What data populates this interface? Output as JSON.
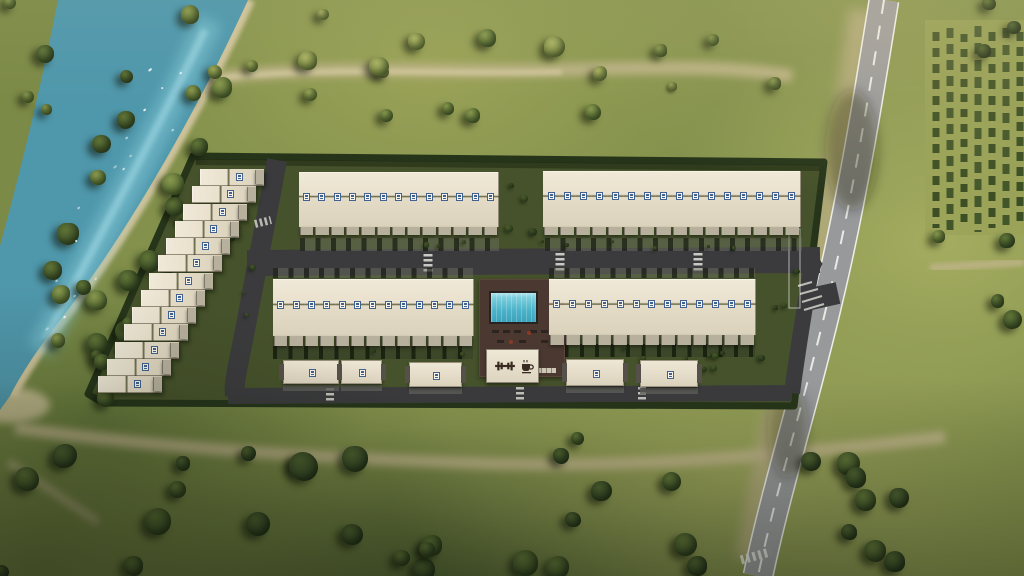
{
  "scene": {
    "title": "Aerial 3D render of a gated townhouse residential development beside a river and a country road"
  },
  "compound": {
    "blocks": [
      {
        "id": "left-stepped-row",
        "label": "stepped townhouse row",
        "units": 13
      },
      {
        "id": "top-left-row",
        "label": "north-west townhouse row",
        "units": 13
      },
      {
        "id": "top-right-row",
        "label": "north-east townhouse row",
        "units": 16
      },
      {
        "id": "mid-left-row",
        "label": "central-west townhouse row",
        "units": 13
      },
      {
        "id": "mid-right-row",
        "label": "central-east townhouse row",
        "units": 13
      }
    ],
    "outbuildings": {
      "count": 5
    },
    "amenities": [
      {
        "icon": "pool"
      },
      {
        "icon": "gym-icon"
      },
      {
        "icon": "cafe-icon"
      }
    ],
    "unit_badge": "unit-badge-icon"
  },
  "colors": {
    "grass": "#83914c",
    "grass-light": "#a9ad60",
    "grass-dark": "#5e7036",
    "water": "#4f97ab",
    "water-light": "#82c8d6",
    "sand": "#cdc19a",
    "road-asphalt": "#98999b",
    "road-line": "#eeeee8",
    "internal-road": "#3b3b3d",
    "hedge": "#26351a",
    "compound-ground": "#46522b",
    "roof-cream": "#eae2cf",
    "terrace": "#b7b09d",
    "badge-blue": "#41628f",
    "deck-brown": "#4a3831",
    "pool-blue": "#4fc0d4",
    "icon-brown": "#3a2b22"
  }
}
